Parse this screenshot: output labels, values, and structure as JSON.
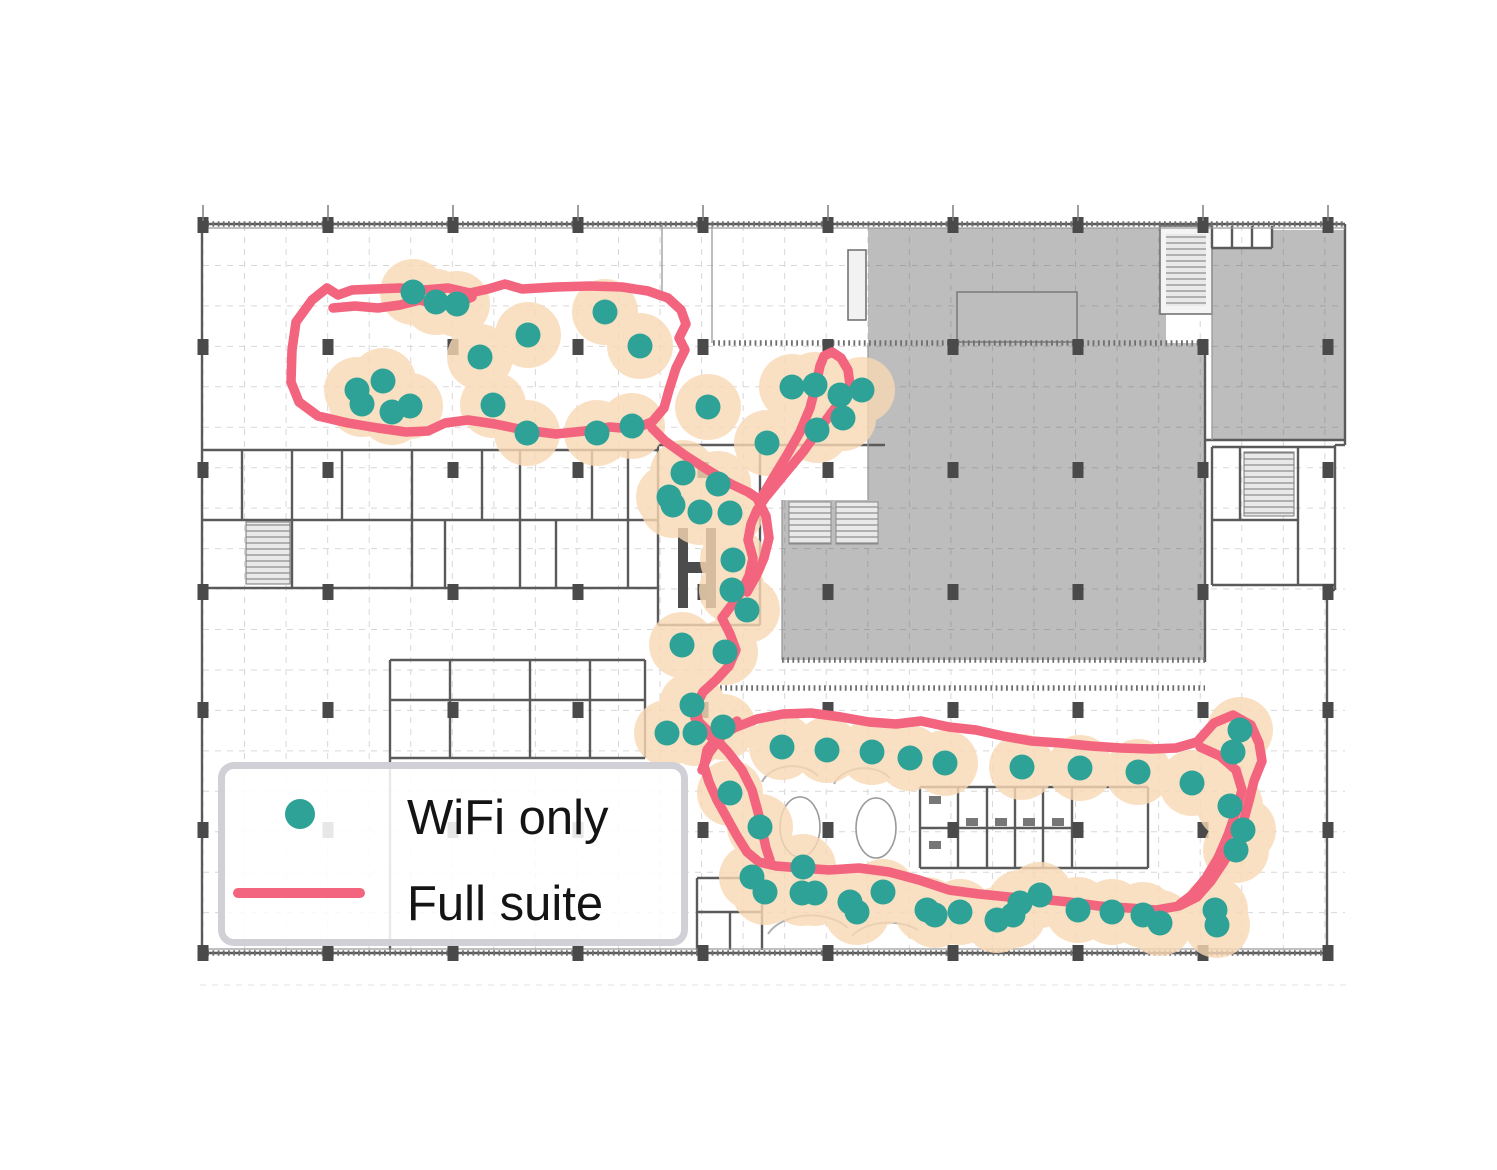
{
  "figure": {
    "description": "Indoor positioning traces drawn over a building floor plan",
    "legend": {
      "items": [
        {
          "label": "WiFi only",
          "marker": "dot",
          "color": "#2EA296"
        },
        {
          "label": "Full suite",
          "marker": "line",
          "color": "#F3647E"
        }
      ]
    },
    "colors": {
      "wifi_dot": "#2EA296",
      "uncertainty_halo": "#FAD9B5",
      "trajectory": "#F3647E",
      "floorplan_fill": "#BDBDBD",
      "wall": "#5A5A5A",
      "grid": "#D7D7D7"
    }
  },
  "chart_data": {
    "type": "scatter",
    "title": "",
    "coordinate_space": "image pixels, 1497x1170, origin top-left",
    "legend_position": "bottom-left",
    "grid": true,
    "series": [
      {
        "name": "WiFi only",
        "marker": "dot",
        "color": "#2EA296",
        "point_radius": 12.5,
        "halo_radius": 33,
        "halo_color": "#FAD9B5",
        "points": [
          [
            413,
            292
          ],
          [
            436,
            302
          ],
          [
            457,
            304
          ],
          [
            480,
            357
          ],
          [
            493,
            405
          ],
          [
            528,
            335
          ],
          [
            527,
            433
          ],
          [
            357,
            390
          ],
          [
            383,
            381
          ],
          [
            362,
            404
          ],
          [
            392,
            412
          ],
          [
            410,
            406
          ],
          [
            597,
            433
          ],
          [
            605,
            312
          ],
          [
            632,
            426
          ],
          [
            640,
            346
          ],
          [
            708,
            407
          ],
          [
            792,
            387
          ],
          [
            815,
            385
          ],
          [
            840,
            395
          ],
          [
            862,
            390
          ],
          [
            843,
            418
          ],
          [
            817,
            430
          ],
          [
            767,
            443
          ],
          [
            683,
            473
          ],
          [
            718,
            484
          ],
          [
            669,
            497
          ],
          [
            673,
            505
          ],
          [
            700,
            512
          ],
          [
            730,
            513
          ],
          [
            733,
            560
          ],
          [
            732,
            590
          ],
          [
            747,
            610
          ],
          [
            682,
            645
          ],
          [
            725,
            652
          ],
          [
            692,
            705
          ],
          [
            667,
            733
          ],
          [
            695,
            733
          ],
          [
            723,
            727
          ],
          [
            782,
            747
          ],
          [
            827,
            750
          ],
          [
            872,
            752
          ],
          [
            910,
            758
          ],
          [
            945,
            763
          ],
          [
            1022,
            767
          ],
          [
            1080,
            768
          ],
          [
            1138,
            772
          ],
          [
            1192,
            783
          ],
          [
            730,
            793
          ],
          [
            760,
            827
          ],
          [
            1240,
            730
          ],
          [
            1233,
            752
          ],
          [
            1230,
            806
          ],
          [
            1243,
            830
          ],
          [
            1236,
            850
          ],
          [
            752,
            877
          ],
          [
            803,
            867
          ],
          [
            765,
            892
          ],
          [
            802,
            893
          ],
          [
            815,
            893
          ],
          [
            850,
            902
          ],
          [
            857,
            912
          ],
          [
            883,
            892
          ],
          [
            927,
            910
          ],
          [
            935,
            915
          ],
          [
            960,
            912
          ],
          [
            997,
            920
          ],
          [
            1013,
            915
          ],
          [
            1020,
            903
          ],
          [
            1040,
            895
          ],
          [
            1078,
            910
          ],
          [
            1112,
            912
          ],
          [
            1143,
            915
          ],
          [
            1160,
            923
          ],
          [
            1215,
            910
          ],
          [
            1217,
            925
          ]
        ]
      },
      {
        "name": "Full suite",
        "marker": "line",
        "color": "#F3647E",
        "stroke_width": 9.5,
        "paths": [
          {
            "closed": true,
            "points": [
              [
                292,
                350
              ],
              [
                296,
                322
              ],
              [
                312,
                300
              ],
              [
                327,
                288
              ],
              [
                338,
                295
              ],
              [
                352,
                290
              ],
              [
                375,
                289
              ],
              [
                400,
                288
              ],
              [
                424,
                290
              ],
              [
                448,
                288
              ],
              [
                470,
                293
              ],
              [
                488,
                289
              ],
              [
                505,
                284
              ],
              [
                522,
                289
              ],
              [
                556,
                287
              ],
              [
                590,
                286
              ],
              [
                622,
                287
              ],
              [
                648,
                291
              ],
              [
                668,
                298
              ],
              [
                681,
                310
              ],
              [
                686,
                324
              ],
              [
                679,
                338
              ],
              [
                685,
                350
              ],
              [
                676,
                368
              ],
              [
                669,
                390
              ],
              [
                664,
                408
              ],
              [
                652,
                422
              ],
              [
                633,
                429
              ],
              [
                610,
                427
              ],
              [
                585,
                431
              ],
              [
                556,
                434
              ],
              [
                524,
                430
              ],
              [
                495,
                424
              ],
              [
                468,
                420
              ],
              [
                445,
                423
              ],
              [
                428,
                431
              ],
              [
                406,
                432
              ],
              [
                378,
                428
              ],
              [
                348,
                423
              ],
              [
                318,
                416
              ],
              [
                299,
                402
              ],
              [
                291,
                382
              ]
            ]
          },
          {
            "closed": false,
            "points": [
              [
                333,
                308
              ],
              [
                355,
                306
              ],
              [
                378,
                308
              ],
              [
                400,
                305
              ],
              [
                420,
                300
              ],
              [
                440,
                306
              ],
              [
                458,
                303
              ],
              [
                472,
                297
              ]
            ]
          },
          {
            "closed": false,
            "points": [
              [
                652,
                428
              ],
              [
                665,
                441
              ],
              [
                686,
                456
              ],
              [
                708,
                470
              ],
              [
                731,
                484
              ],
              [
                748,
                492
              ],
              [
                760,
                500
              ],
              [
                773,
                478
              ],
              [
                787,
                455
              ],
              [
                800,
                432
              ],
              [
                810,
                408
              ],
              [
                816,
                385
              ],
              [
                820,
                366
              ],
              [
                824,
                356
              ],
              [
                832,
                352
              ],
              [
                841,
                358
              ],
              [
                848,
                370
              ],
              [
                850,
                385
              ],
              [
                844,
                397
              ],
              [
                832,
                412
              ],
              [
                818,
                431
              ],
              [
                803,
                452
              ],
              [
                788,
                470
              ],
              [
                774,
                487
              ],
              [
                765,
                498
              ],
              [
                757,
                510
              ],
              [
                751,
                524
              ],
              [
                748,
                540
              ],
              [
                753,
                558
              ],
              [
                749,
                576
              ],
              [
                741,
                592
              ],
              [
                731,
                606
              ],
              [
                722,
                618
              ],
              [
                730,
                634
              ],
              [
                736,
                650
              ],
              [
                729,
                666
              ],
              [
                716,
                680
              ],
              [
                703,
                692
              ],
              [
                696,
                706
              ],
              [
                698,
                720
              ],
              [
                706,
                732
              ],
              [
                714,
                740
              ],
              [
                734,
                728
              ],
              [
                757,
                719
              ],
              [
                783,
                714
              ],
              [
                811,
                713
              ],
              [
                841,
                717
              ],
              [
                869,
                722
              ],
              [
                896,
                724
              ],
              [
                921,
                721
              ],
              [
                949,
                727
              ],
              [
                976,
                730
              ],
              [
                1003,
                736
              ],
              [
                1031,
                741
              ],
              [
                1061,
                743
              ],
              [
                1091,
                746
              ],
              [
                1121,
                748
              ],
              [
                1151,
                749
              ],
              [
                1176,
                748
              ],
              [
                1197,
                742
              ],
              [
                1214,
                723
              ],
              [
                1233,
                715
              ],
              [
                1251,
                725
              ],
              [
                1259,
                743
              ],
              [
                1262,
                761
              ],
              [
                1254,
                781
              ],
              [
                1249,
                801
              ],
              [
                1243,
                823
              ],
              [
                1235,
                844
              ],
              [
                1223,
                863
              ],
              [
                1211,
                881
              ],
              [
                1197,
                897
              ],
              [
                1179,
                906
              ],
              [
                1156,
                910
              ],
              [
                1129,
                908
              ],
              [
                1099,
                906
              ],
              [
                1069,
                902
              ],
              [
                1039,
                899
              ],
              [
                1009,
                897
              ],
              [
                979,
                894
              ],
              [
                949,
                890
              ],
              [
                919,
                880
              ],
              [
                889,
                872
              ],
              [
                859,
                868
              ],
              [
                829,
                870
              ],
              [
                801,
                868
              ],
              [
                776,
                866
              ],
              [
                759,
                862
              ],
              [
                747,
                852
              ],
              [
                737,
                836
              ],
              [
                727,
                818
              ],
              [
                717,
                800
              ],
              [
                709,
                782
              ],
              [
                704,
                766
              ],
              [
                707,
                750
              ],
              [
                715,
                740
              ]
            ]
          },
          {
            "closed": false,
            "points": [
              [
                757,
                498
              ],
              [
                766,
                516
              ],
              [
                769,
                538
              ],
              [
                764,
                558
              ],
              [
                756,
                576
              ],
              [
                747,
                592
              ]
            ]
          },
          {
            "closed": false,
            "points": [
              [
                695,
                718
              ],
              [
                712,
                735
              ],
              [
                728,
                752
              ],
              [
                742,
                770
              ],
              [
                752,
                790
              ],
              [
                758,
                812
              ],
              [
                762,
                830
              ],
              [
                766,
                848
              ],
              [
                770,
                860
              ]
            ]
          },
          {
            "closed": false,
            "points": [
              [
                737,
                721
              ],
              [
                721,
                737
              ],
              [
                709,
                753
              ],
              [
                702,
                770
              ]
            ]
          },
          {
            "closed": false,
            "points": [
              [
                1200,
                747
              ],
              [
                1220,
                756
              ],
              [
                1236,
                770
              ],
              [
                1242,
                790
              ],
              [
                1236,
                812
              ],
              [
                1228,
                835
              ],
              [
                1218,
                858
              ],
              [
                1206,
                878
              ],
              [
                1192,
                895
              ],
              [
                1180,
                904
              ]
            ]
          }
        ]
      }
    ]
  }
}
